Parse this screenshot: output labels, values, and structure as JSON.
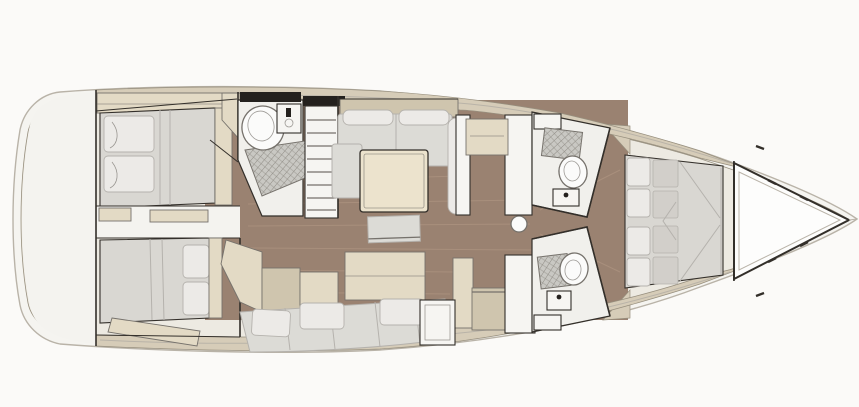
{
  "diagram": {
    "type": "yacht-interior-floor-plan",
    "orientation": "bow-right",
    "colors": {
      "background": "#fbfaf8",
      "hull": "#f5f4f0",
      "hullLine": "#b9b3a8",
      "deck": "#edeae2",
      "sternFill": "#f4f3ef",
      "band": "#d6ccb8",
      "bandLine": "#978f7e",
      "wood": "#9a8271",
      "woodStreak": "#b49a86",
      "wall": "#332f2a",
      "room": "#f1f0ec",
      "furnitureBeige": "#e3dac5",
      "furnitureBeigeDark": "#cfc5ae",
      "cushion": "#dcdbd6",
      "cushionShade": "#b5b2ad",
      "pillow": "#eceae7",
      "mattress": "#d9d7d2",
      "quilt": "#d2cfca",
      "white": "#f6f5f2",
      "grate": "#c9c8c3",
      "table": "#ece3cd",
      "windowDark": "#24211e",
      "fixtureLine": "#76726c",
      "bowTriangle": "#fdfdfc"
    },
    "parts": [
      "hull-outline",
      "stern-platform",
      "side-deck-top",
      "side-deck-bottom",
      "aft-cabin-top-berth",
      "aft-cabin-bottom-berth",
      "cabin-divider",
      "aft-head-toilet",
      "aft-head-sink",
      "aft-head-shower-grate",
      "companionway-steps",
      "saloon-sofa",
      "dining-table",
      "coffee-bench",
      "saloon-settee",
      "galley-side-tables",
      "galley-counters",
      "fridge-unit",
      "bulkhead-door",
      "mast-post",
      "fwd-head-top-toilet",
      "fwd-head-top-shower-grate",
      "fwd-head-top-sink",
      "fwd-head-bottom-toilet",
      "fwd-head-bottom-shower-grate",
      "fwd-head-bottom-sink",
      "owner-cabin-berth",
      "owner-cabin-pillows",
      "bow-sail-locker"
    ]
  }
}
